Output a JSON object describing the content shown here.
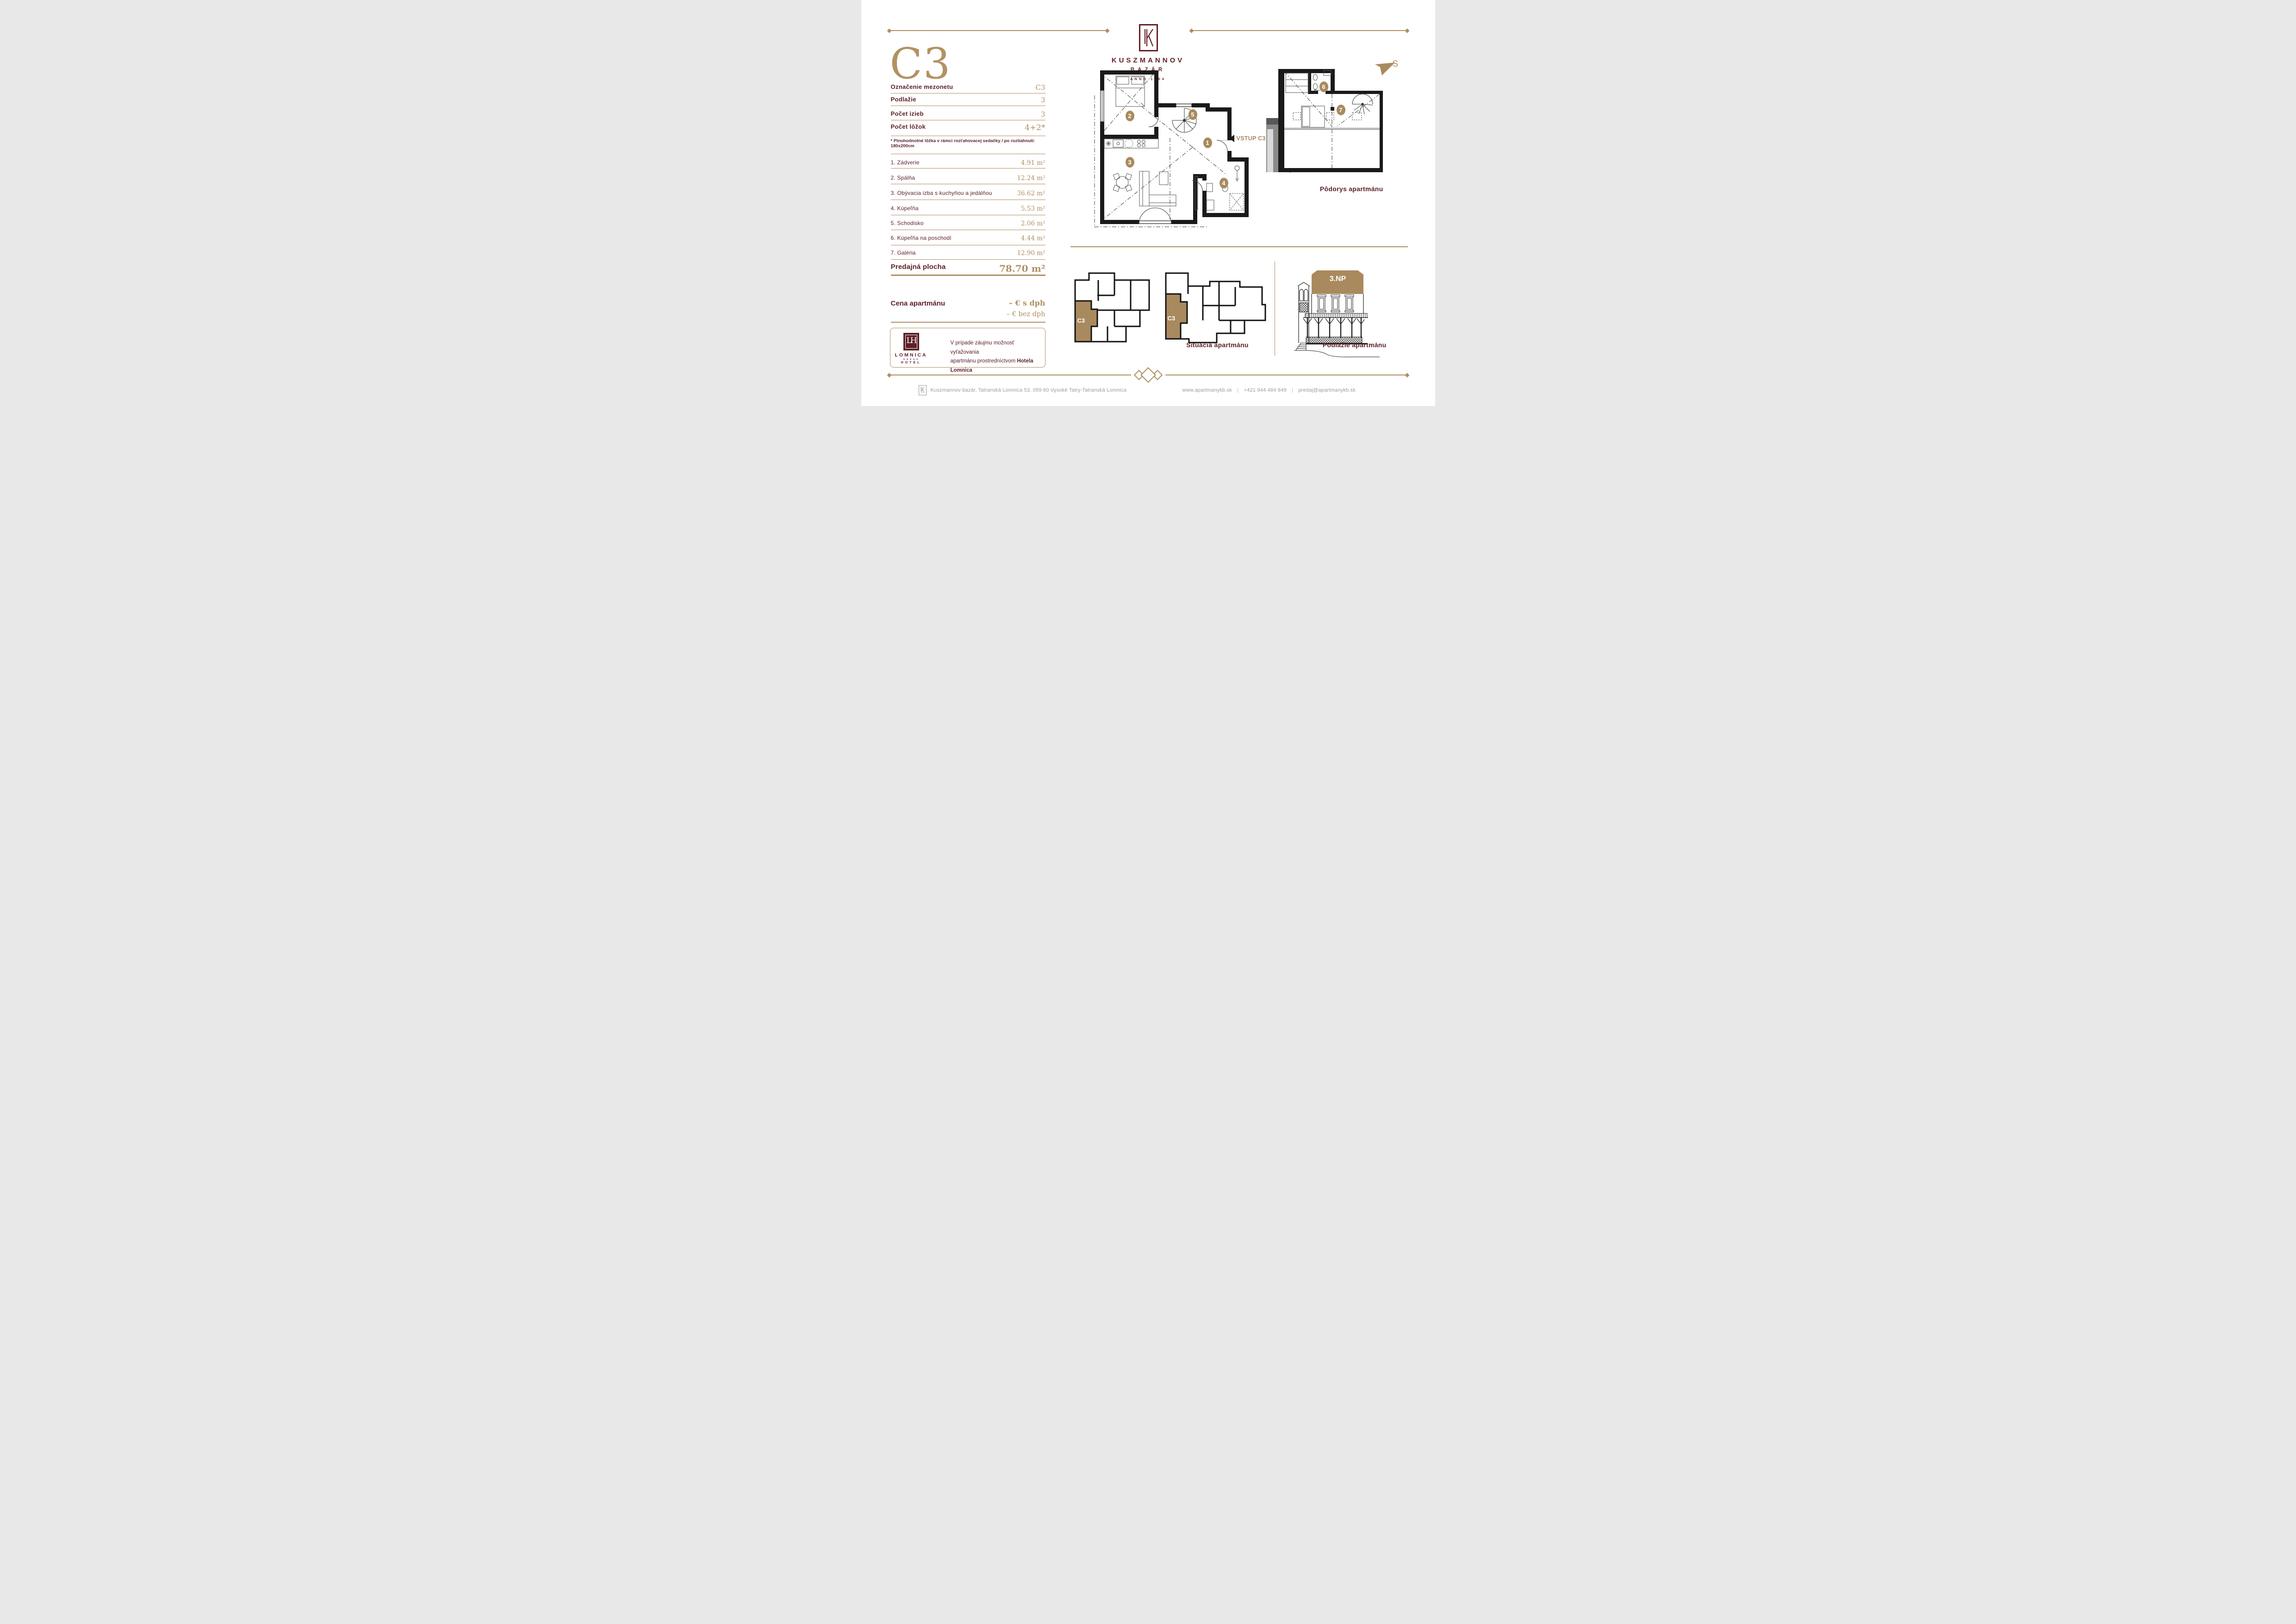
{
  "header": {
    "brand": "KUSZMANNOV",
    "sub_brand": "BAZÁR",
    "anno": "ANNO 1904",
    "compass_label": "S"
  },
  "apartment": {
    "title": "C3",
    "specs": [
      {
        "label": "Označenie mezonetu",
        "value": "C3"
      },
      {
        "label": "Podlažie",
        "value": "3"
      },
      {
        "label": "Počet izieb",
        "value": "3"
      },
      {
        "label": "Počet lôžok",
        "value": "4+2*"
      }
    ],
    "note": "* Plnohodnotné lôžka v rámci rozťahovacej sedačky / po roztiahnutí: 180x200cm",
    "rooms": [
      {
        "num": "1",
        "label": "1. Zádverie",
        "area": "4.91",
        "unit": "m²"
      },
      {
        "num": "2",
        "label": "2. Spálňa",
        "area": "12.24",
        "unit": "m²"
      },
      {
        "num": "3",
        "label": "3. Obývacia izba s kuchyňou a jedálňou",
        "area": "36.62",
        "unit": "m²"
      },
      {
        "num": "4",
        "label": "4. Kúpeľňa",
        "area": "5.53",
        "unit": "m²"
      },
      {
        "num": "5",
        "label": "5. Schodisko",
        "area": "2.06",
        "unit": "m²"
      },
      {
        "num": "6",
        "label": "6. Kúpeľňa na poschodí",
        "area": "4.44",
        "unit": "m²"
      },
      {
        "num": "7",
        "label": "7. Galéria",
        "area": "12.90",
        "unit": "m²"
      }
    ],
    "total": {
      "label": "Predajná plocha",
      "value": "78.70",
      "unit": "m²"
    },
    "price": {
      "label": "Cena apartmánu",
      "with_vat": "– € s dph",
      "without_vat": "– € bez dph"
    }
  },
  "hotel_box": {
    "logo_monogram": "LH",
    "logo_name": "LOMNICA",
    "logo_stars": "✶✶✶✶✶",
    "logo_hotel": "HOTEL",
    "text_line1": "V prípade záujmu možnosť vyťažovania",
    "text_line2": "apartmánu prostredníctvom",
    "text_line2_bold": "Hotela Lomnica"
  },
  "plans": {
    "entry_label": "VSTUP C3",
    "floor_badge": "3.NP",
    "situation_unit_label": "C3",
    "floor_plan_caption": "Pôdorys apartmánu",
    "situation_caption": "Situácia apartmánu",
    "elevation_caption": "Podlažie apartmánu"
  },
  "footer": {
    "address": "Kuszmannov bazár, Tatranská Lomnica 53, 059 60 Vysoké Tatry-Tatranská Lomnica",
    "website": "www.apartmanykb.sk",
    "phone": "+421 944 484 849",
    "email": "predaj@apartmanykb.sk",
    "separator": "|"
  },
  "colors": {
    "gold": "#B08E62",
    "maroon": "#5C2127",
    "logo_maroon": "#641F27",
    "footer_gray": "#9C9B99",
    "wall_black": "#1A1A18",
    "highlight_gold": "#A98A5F"
  }
}
